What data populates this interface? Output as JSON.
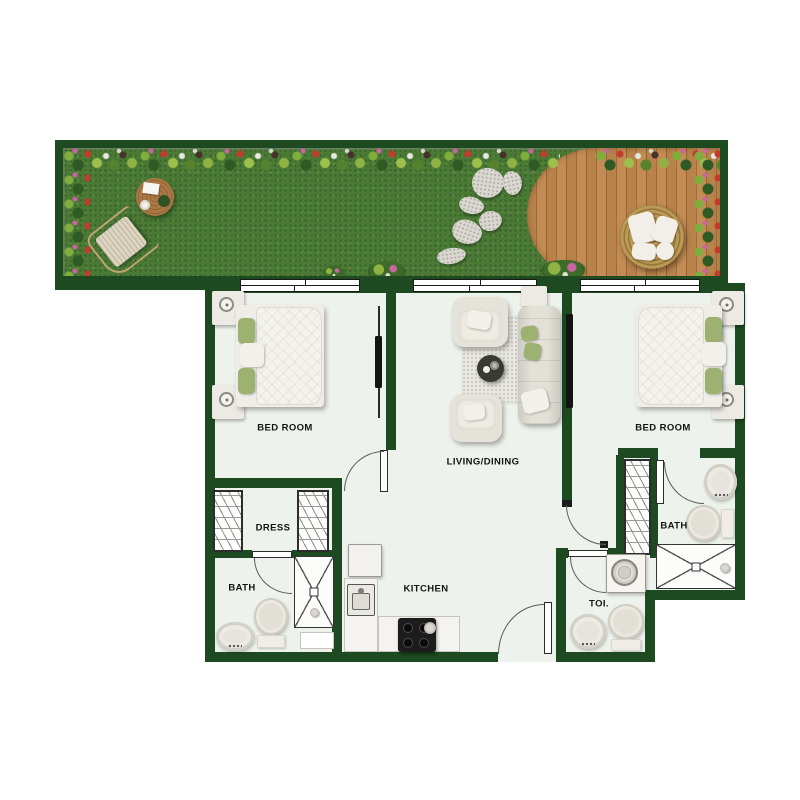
{
  "document": {
    "type": "apartment-floor-plan",
    "description": "Two-bedroom apartment floor plan with garden terrace, lawn and wood deck"
  },
  "labels": {
    "bedroom_left": "BED ROOM",
    "bedroom_right": "BED ROOM",
    "living_dining": "LIVING/DINING",
    "dress": "DRESS",
    "bath_left": "BATH",
    "bath_right": "BATH",
    "kitchen": "KITCHEN",
    "toilet": "TOI."
  },
  "palette": {
    "wall_green": "#1e4a22",
    "floor": "#eef2ec",
    "grass": "#4a7a36",
    "deck_wood": "#b57d47",
    "background": "#ffffff",
    "label_text": "#141414",
    "pillow_green": "#9db170"
  },
  "garden_features": [
    "flower-border",
    "lawn",
    "round-wood-table",
    "lounge-chair",
    "stepping-stones",
    "wood-deck",
    "round-daybed"
  ],
  "fixture_names": [
    "bed",
    "wardrobe",
    "sofa",
    "armchair",
    "coffee-table",
    "rug",
    "tv",
    "shower",
    "toilet",
    "washbasin",
    "washing-machine",
    "refrigerator",
    "kitchen-sink",
    "cooktop",
    "sliding-window",
    "swing-door"
  ]
}
